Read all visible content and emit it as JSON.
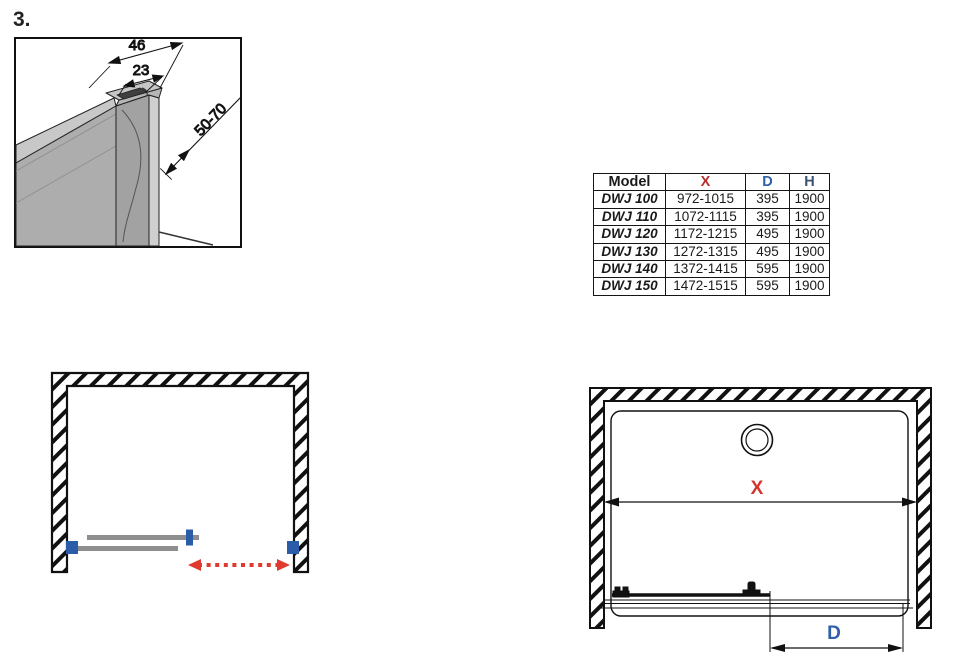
{
  "page": {
    "step_label": "3."
  },
  "detail": {
    "dims": {
      "outer": "46",
      "inner": "23",
      "range": "50-70"
    }
  },
  "table": {
    "headers": {
      "model": "Model",
      "x": "X",
      "d": "D",
      "h": "H_label"
    },
    "header_h_text": "H",
    "rows": [
      {
        "model": "DWJ 100",
        "x": "972-1015",
        "d": "395",
        "h": "1900"
      },
      {
        "model": "DWJ 110",
        "x": "1072-1115",
        "d": "395",
        "h": "1900"
      },
      {
        "model": "DWJ 120",
        "x": "1172-1215",
        "d": "495",
        "h": "1900"
      },
      {
        "model": "DWJ 130",
        "x": "1272-1315",
        "d": "495",
        "h": "1900"
      },
      {
        "model": "DWJ 140",
        "x": "1372-1415",
        "d": "595",
        "h": "1900"
      },
      {
        "model": "DWJ 150",
        "x": "1472-1515",
        "d": "595",
        "h": "1900"
      }
    ],
    "header_model": "Model",
    "header_x": "X",
    "header_d": "D",
    "header_h": "H"
  },
  "front": {
    "x_label": "X",
    "d_label": "D"
  },
  "colors": {
    "dimension_red": "#d5332d",
    "table_x_red": "#b5312c",
    "accent_blue": "#2e5fa8",
    "table_h_navy": "#3b5272",
    "panel_gray": "#8e8e8e"
  }
}
